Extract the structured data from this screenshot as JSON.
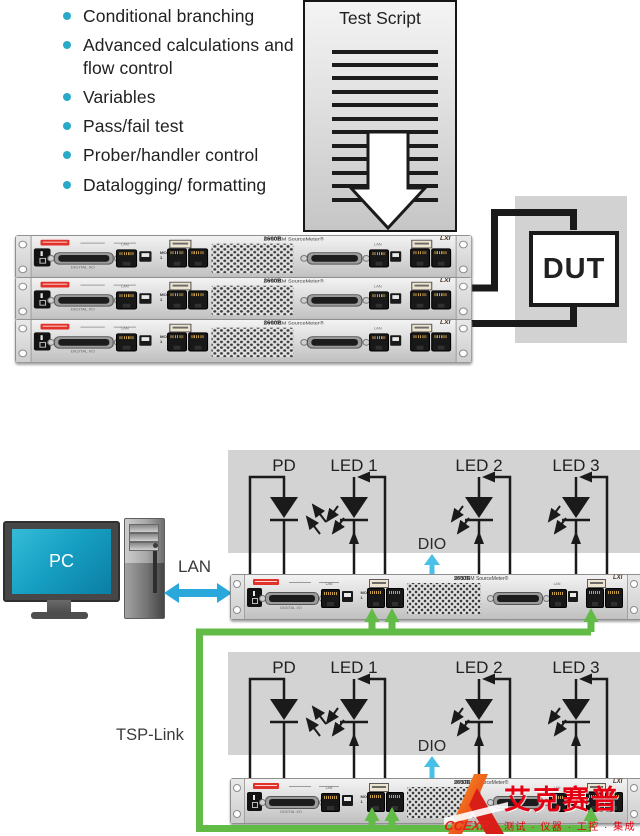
{
  "features": {
    "items": [
      "Conditional branching",
      "Advanced calculations and flow control",
      "Variables",
      "Pass/fail test",
      "Prober/handler control",
      "Datalogging/ formatting"
    ]
  },
  "test_script": {
    "title": "Test Script"
  },
  "dut": {
    "label": "DUT"
  },
  "pc": {
    "label": "PC"
  },
  "lan": {
    "label": "LAN"
  },
  "tsp": {
    "label": "TSP-Link"
  },
  "circuit": {
    "pd": "PD",
    "led1": "LED 1",
    "led2": "LED 2",
    "led3": "LED 3",
    "dio": "DIO"
  },
  "instrument": {
    "model": "2600B",
    "name": "SYSTEM SourceMeter®",
    "lxi": "LXI",
    "digital_io": "DIGITAL I/O",
    "lan_port": "LAN",
    "mod": "MOD",
    "mod_num": "1"
  },
  "watermark": {
    "brand_cn": "艾克赛普",
    "tagline": "测试 · 仪器 · 工控 · 集成",
    "url": "www.accexp.net"
  },
  "colors": {
    "bullet_cyan": "#2aa9c8",
    "tsp_green": "#62bb46",
    "lan_blue": "#2aa8dc",
    "dio_cyan": "#49c0e8",
    "watermark_red": "#e60012"
  }
}
